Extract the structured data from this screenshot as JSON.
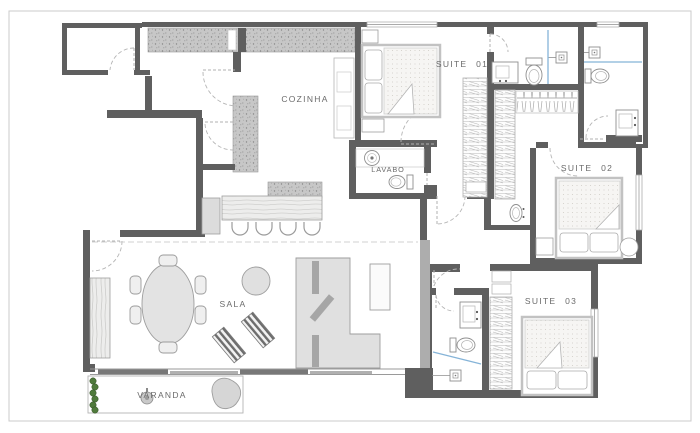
{
  "plan": {
    "rooms": {
      "cozinha": {
        "label": "COZINHA"
      },
      "suite01": {
        "label": "SUITE 01"
      },
      "suite02": {
        "label": "SUITE 02"
      },
      "suite03": {
        "label": "SUITE 03"
      },
      "lavabo": {
        "label": "LAVABO"
      },
      "sala": {
        "label": "SALA"
      },
      "varanda": {
        "label": "VARANDA"
      }
    },
    "colors": {
      "wall": "#5f5f5f",
      "masonry_hatch": "#c7c7c7",
      "furniture_fill": "#e3e3e3",
      "furniture_outline": "#9b9b9b",
      "door_arc": "#b5b5b5",
      "glass_partition": "#85b4d8",
      "plant_green": "#4f7a3b",
      "label_text": "#6b6b6b",
      "sheet_frame": "#cbcbcb"
    },
    "fixtures": [
      "double-bed",
      "pillow",
      "blanket-fold",
      "nightstand",
      "wardrobe-shelves",
      "hanging-closet",
      "toilet",
      "vanity-sink",
      "round-sink",
      "wall-basin",
      "shower-drain",
      "glass-partition",
      "dining-table",
      "dining-chair",
      "bar-stool",
      "kitchen-island",
      "refrigerator",
      "kitchen-counter",
      "sofa",
      "sofa-cushion",
      "tv-cabinet",
      "sideboard",
      "pouf",
      "striped-ottoman",
      "bean-ottoman",
      "plant-pot",
      "hedge",
      "sliding-door",
      "window",
      "door-swing"
    ]
  }
}
